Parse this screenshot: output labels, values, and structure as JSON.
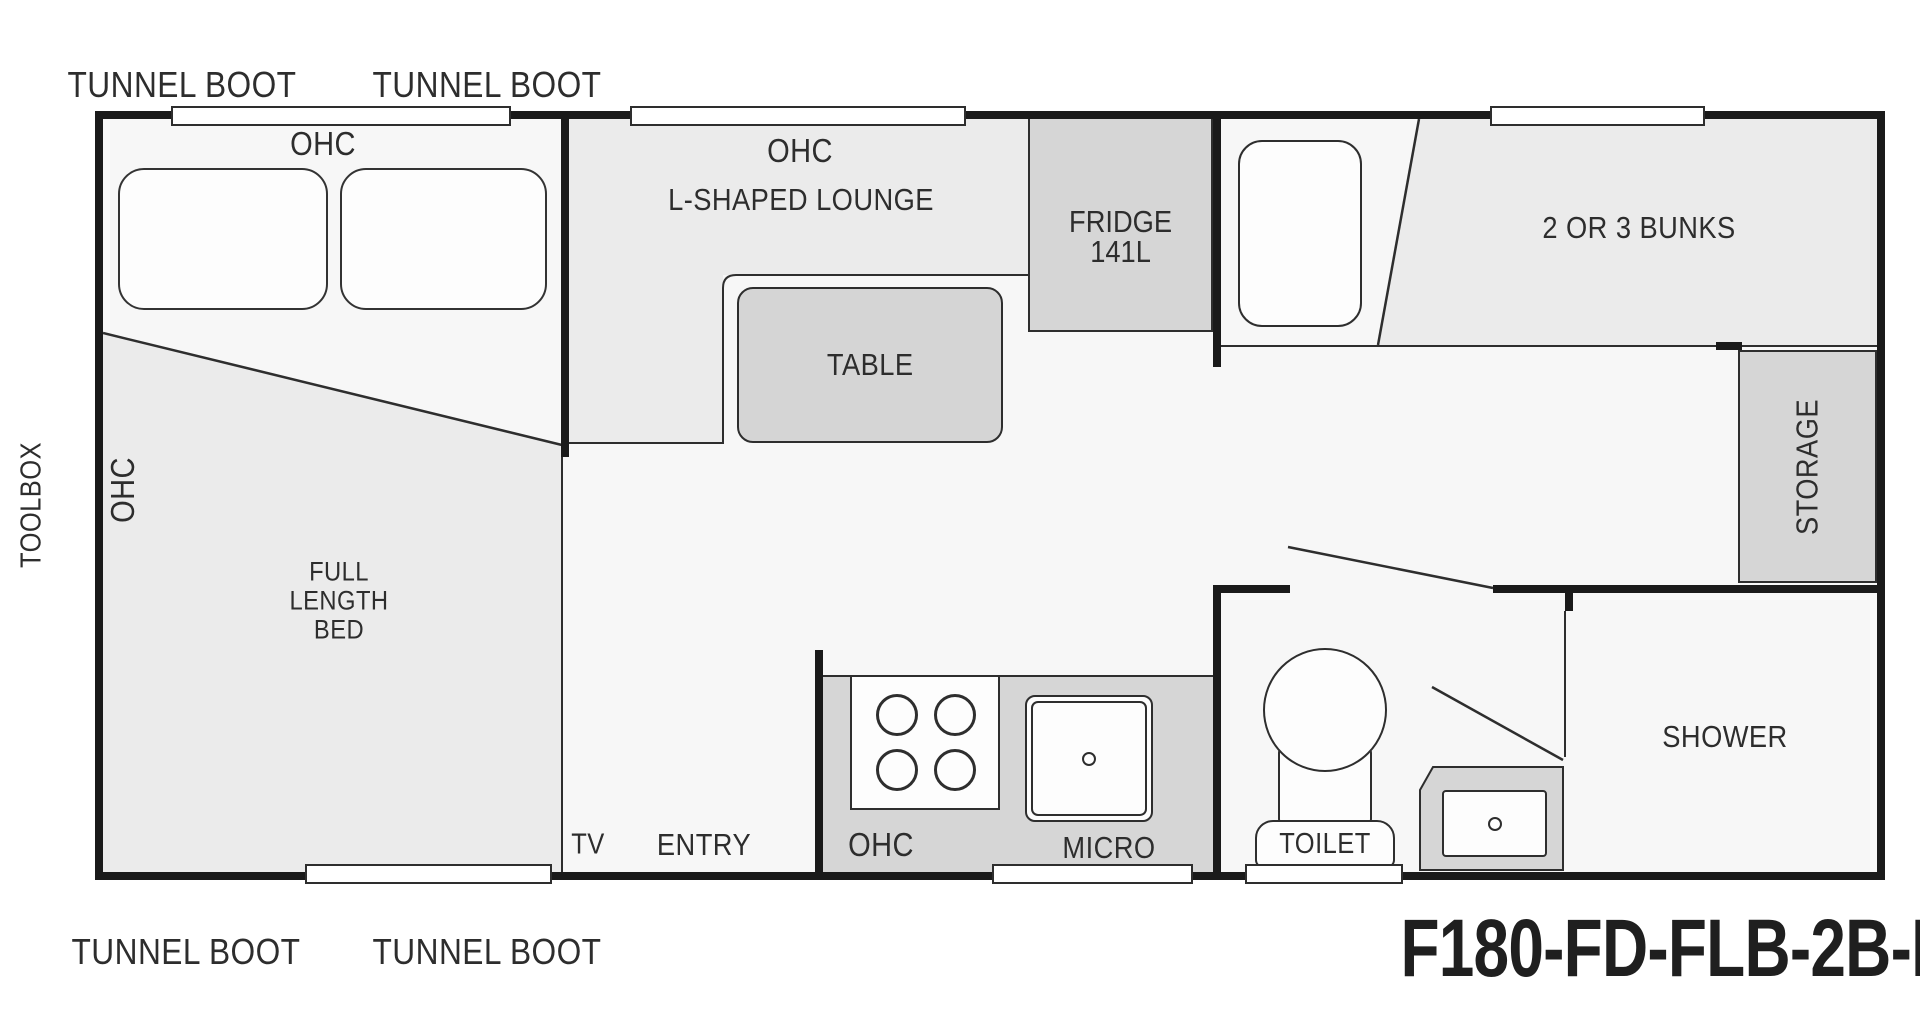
{
  "model_code": "F180-FD-FLB-2B-LS",
  "outside": {
    "tunnel_boot": "TUNNEL BOOT",
    "toolbox": "TOOLBOX"
  },
  "bedroom": {
    "ohc_top": "OHC",
    "ohc_side": "OHC",
    "bed_lines": [
      "FULL",
      "LENGTH",
      "BED"
    ]
  },
  "lounge": {
    "ohc": "OHC",
    "name": "L-SHAPED LOUNGE",
    "table": "TABLE"
  },
  "kitchen": {
    "fridge_name": "FRIDGE",
    "fridge_capacity": "141L",
    "ohc": "OHC",
    "micro": "MICRO",
    "entry": "ENTRY",
    "tv": "TV"
  },
  "rear": {
    "bunks": "2 OR 3 BUNKS",
    "storage": "STORAGE",
    "shower": "SHOWER",
    "toilet": "TOILET"
  },
  "palette": {
    "wall": "#1a1a1a",
    "line": "#2e2e2e",
    "floor": "#f7f7f7",
    "zone_light": "#ebebeb",
    "zone_mid": "#d6d6d6",
    "fixture_white": "#fdfdfd",
    "text": "#2d2d2d"
  }
}
